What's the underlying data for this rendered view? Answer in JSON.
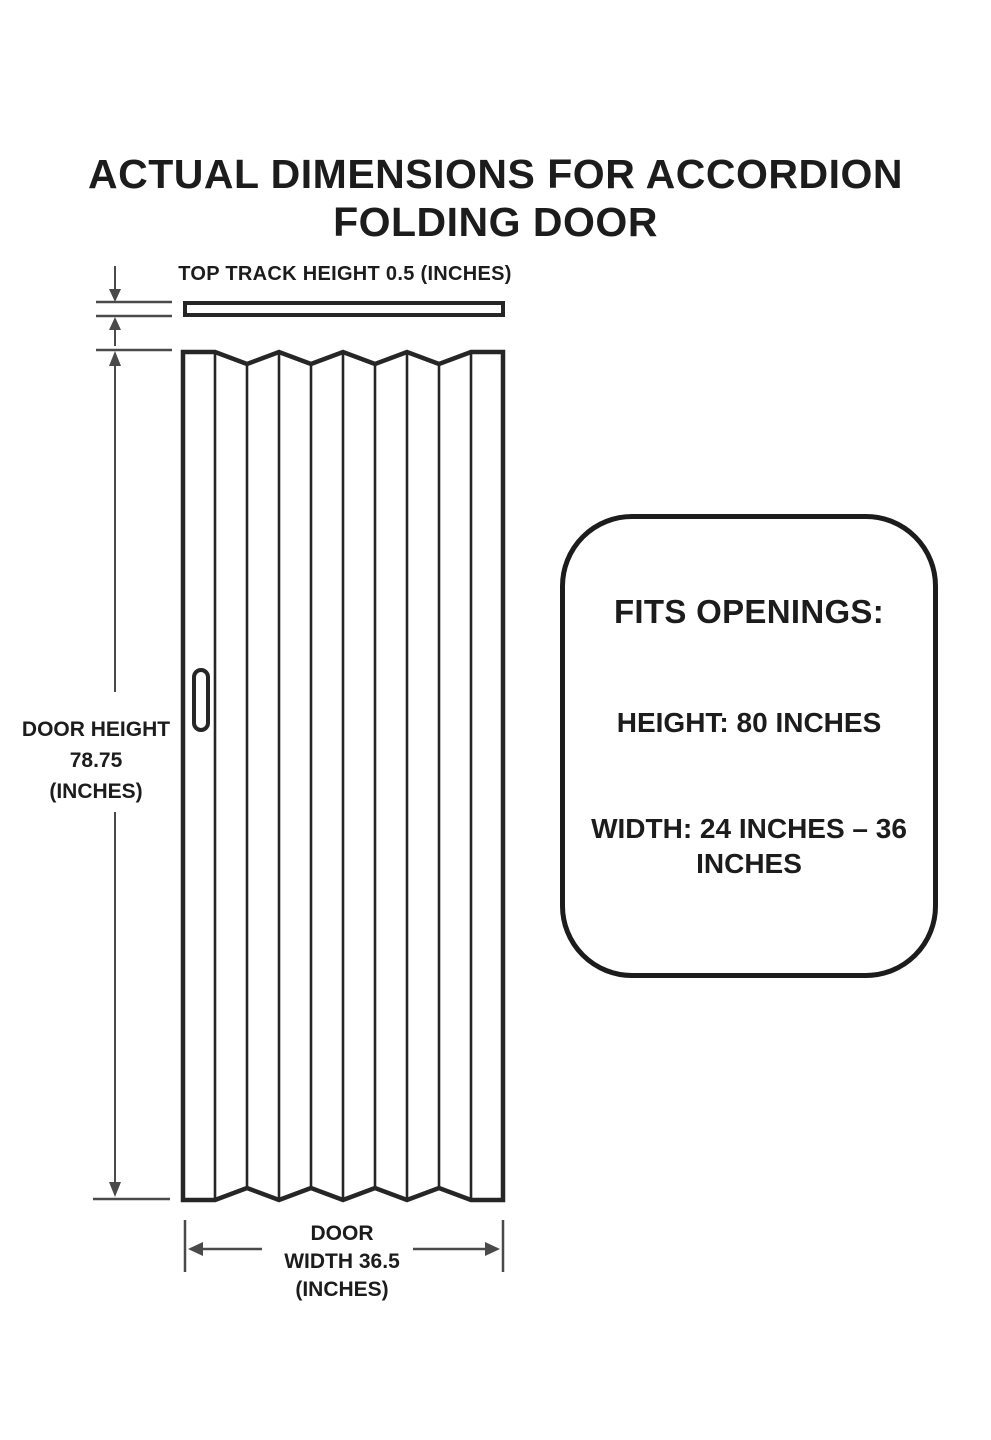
{
  "title": {
    "line1": "ACTUAL DIMENSIONS FOR ACCORDION",
    "line2": "FOLDING DOOR"
  },
  "labels": {
    "top_track": "TOP TRACK HEIGHT 0.5 (INCHES)",
    "door_height_name": "DOOR HEIGHT",
    "door_height_value": "78.75",
    "door_height_unit": "(INCHES)",
    "door_width_name": "DOOR",
    "door_width_value": "WIDTH 36.5",
    "door_width_unit": "(INCHES)"
  },
  "fits_openings": {
    "heading": "FITS OPENINGS:",
    "height": "HEIGHT: 80 INCHES",
    "width_line1": "WIDTH: 24 INCHES – 36",
    "width_line2": "INCHES"
  },
  "measurements": {
    "top_track_height_inches": 0.5,
    "door_height_inches": 78.75,
    "door_width_inches": 36.5,
    "opening_height_inches": 80,
    "opening_width_min_inches": 24,
    "opening_width_max_inches": 36
  },
  "colors": {
    "ink": "#1c1c1c",
    "line": "#4a4a4a",
    "paper": "#ffffff"
  }
}
